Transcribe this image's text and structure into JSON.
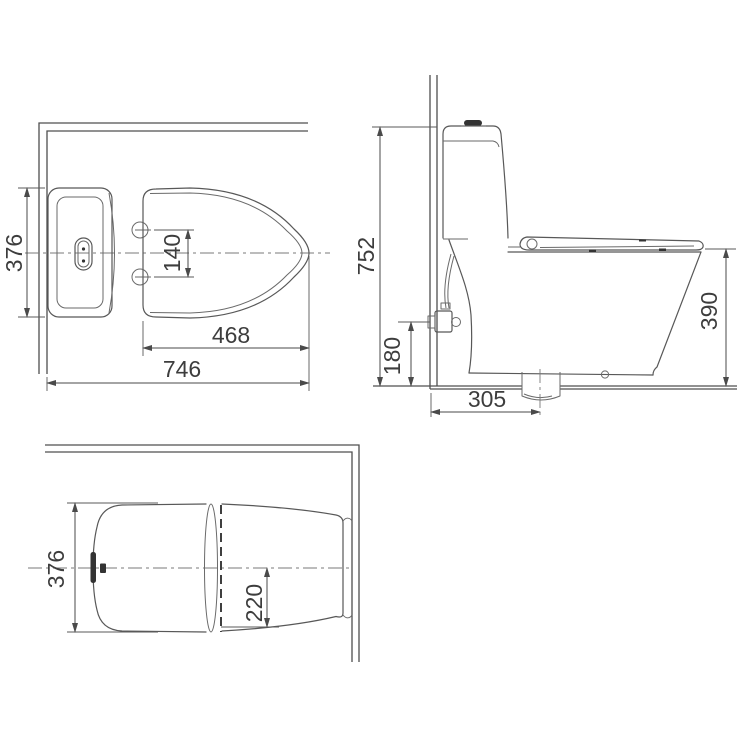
{
  "drawing": {
    "colors": {
      "line": "#585858",
      "dimension": "#4a4a4a",
      "text": "#3d3d3d",
      "dark_fill": "#333333",
      "background": "#ffffff"
    },
    "top_view": {
      "width": "376",
      "hinge_spacing": "140",
      "seat_depth": "468",
      "total_depth": "746"
    },
    "side_view": {
      "total_height": "752",
      "valve_height": "180",
      "bowl_height": "390",
      "drain_setout": "305"
    },
    "front_view": {
      "width": "376",
      "base_offset": "220"
    }
  }
}
